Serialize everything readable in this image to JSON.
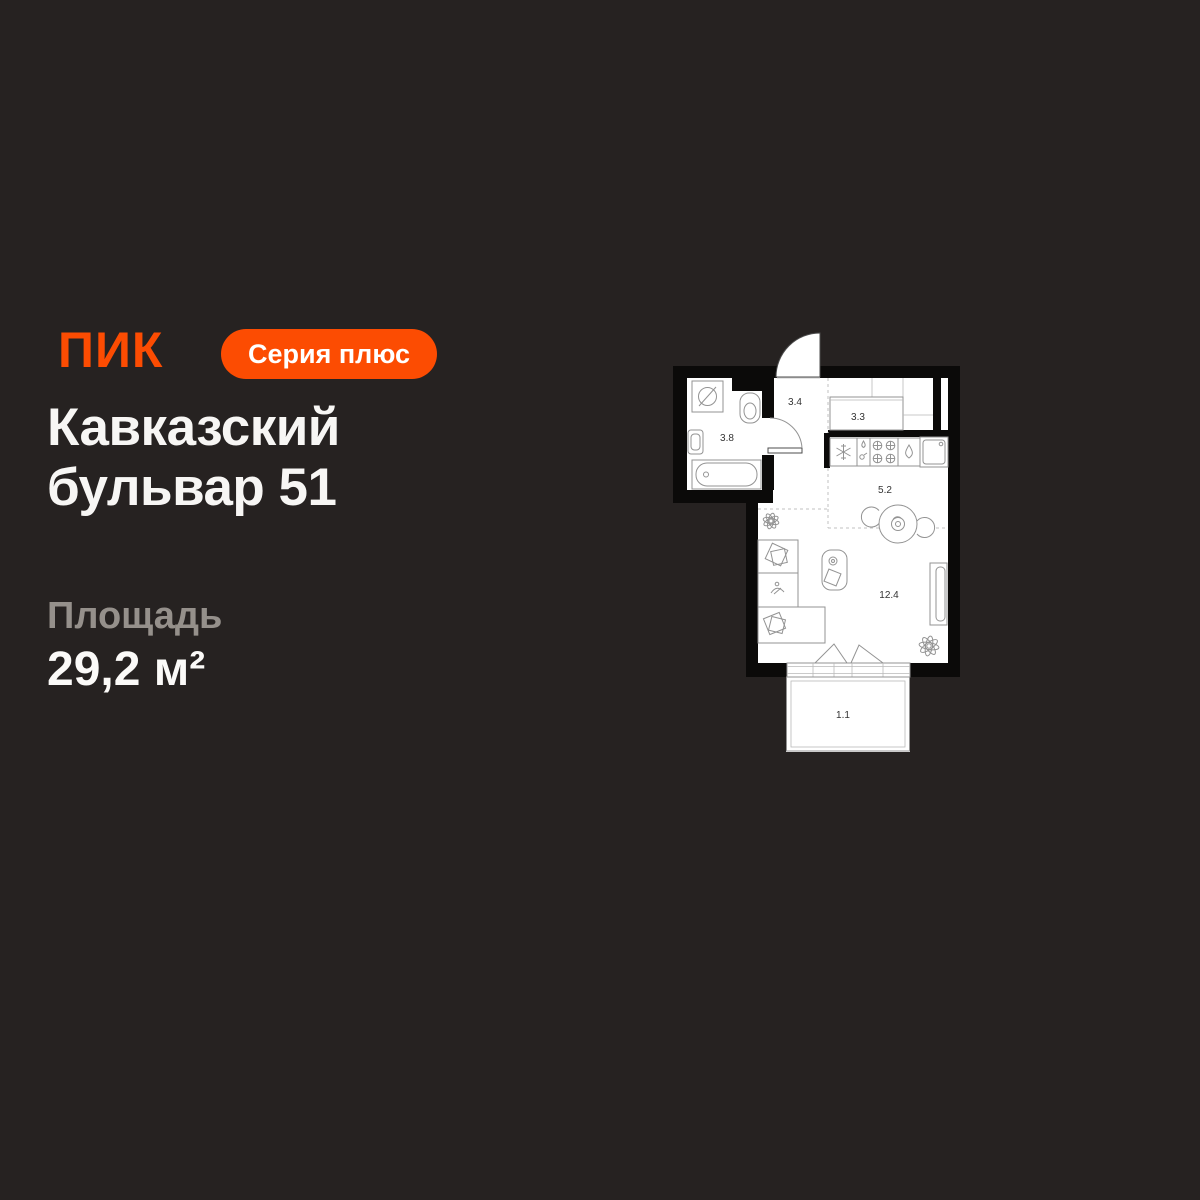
{
  "brand": {
    "logo": "ПИК",
    "badge": "Серия плюс"
  },
  "listing": {
    "title_line1": "Кавказский",
    "title_line2": "бульвар 51",
    "area_label": "Площадь",
    "area_value": "29,2 м²"
  },
  "floorplan": {
    "rooms": [
      {
        "name": "bathroom",
        "area": "3.8"
      },
      {
        "name": "hallway",
        "area": "3.4"
      },
      {
        "name": "closet",
        "area": "3.3"
      },
      {
        "name": "kitchen",
        "area": "5.2"
      },
      {
        "name": "living-room",
        "area": "12.4"
      },
      {
        "name": "balcony",
        "area": "1.1"
      }
    ]
  },
  "colors": {
    "background": "#262221",
    "accent": "#FC4C02",
    "text_primary": "#F7F6F4",
    "text_muted": "#95908B",
    "plan_walls": "#0B0A09",
    "plan_floor": "#FFFFFF"
  }
}
